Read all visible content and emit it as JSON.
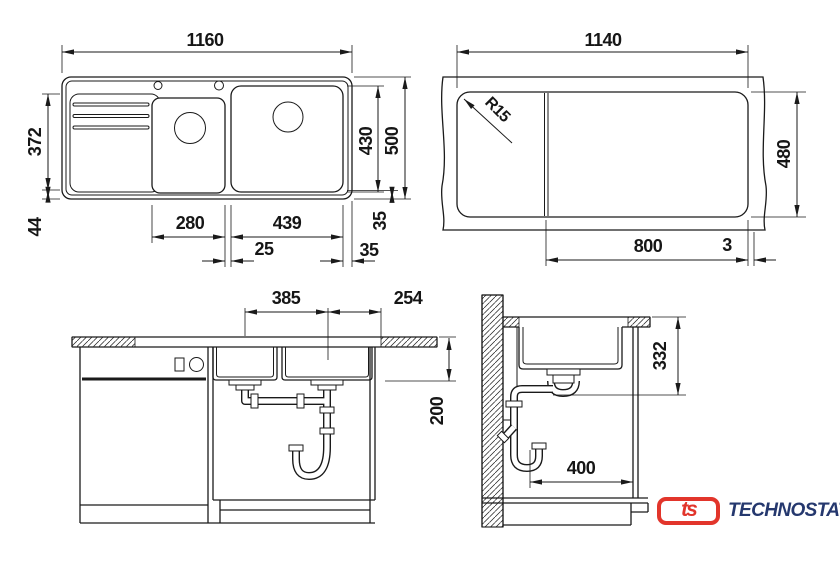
{
  "page": {
    "background": "#ffffff",
    "line_color": "#1a1a1a"
  },
  "views": {
    "top_view": {
      "title": "sink-top-view",
      "dims": {
        "overall_width": "1160",
        "overall_depth": "500",
        "bowl_area_depth": "430",
        "drainboard_depth": "372",
        "front_edge": "44",
        "small_bowl_width": "280",
        "large_bowl_width": "439",
        "bowl_gap": "25",
        "rear_margin": "35",
        "side_margin": "35"
      }
    },
    "cutout_view": {
      "title": "countertop-cutout-view",
      "dims": {
        "cutout_width": "1140",
        "cutout_depth": "480",
        "corner_radius": "R15",
        "bowl_section_width": "800",
        "edge_gap": "3"
      }
    },
    "front_view": {
      "title": "front-elevation",
      "dims": {
        "bowl_span": "385",
        "right_offset": "254",
        "bowl_depth": "200"
      }
    },
    "side_view": {
      "title": "side-section",
      "dims": {
        "drain_height": "332",
        "trap_clearance": "400"
      }
    }
  },
  "branding": {
    "badge": "ts",
    "name": "TECHNOSTATUS",
    "badge_color": "#e2352b",
    "text_color": "#25386e"
  }
}
